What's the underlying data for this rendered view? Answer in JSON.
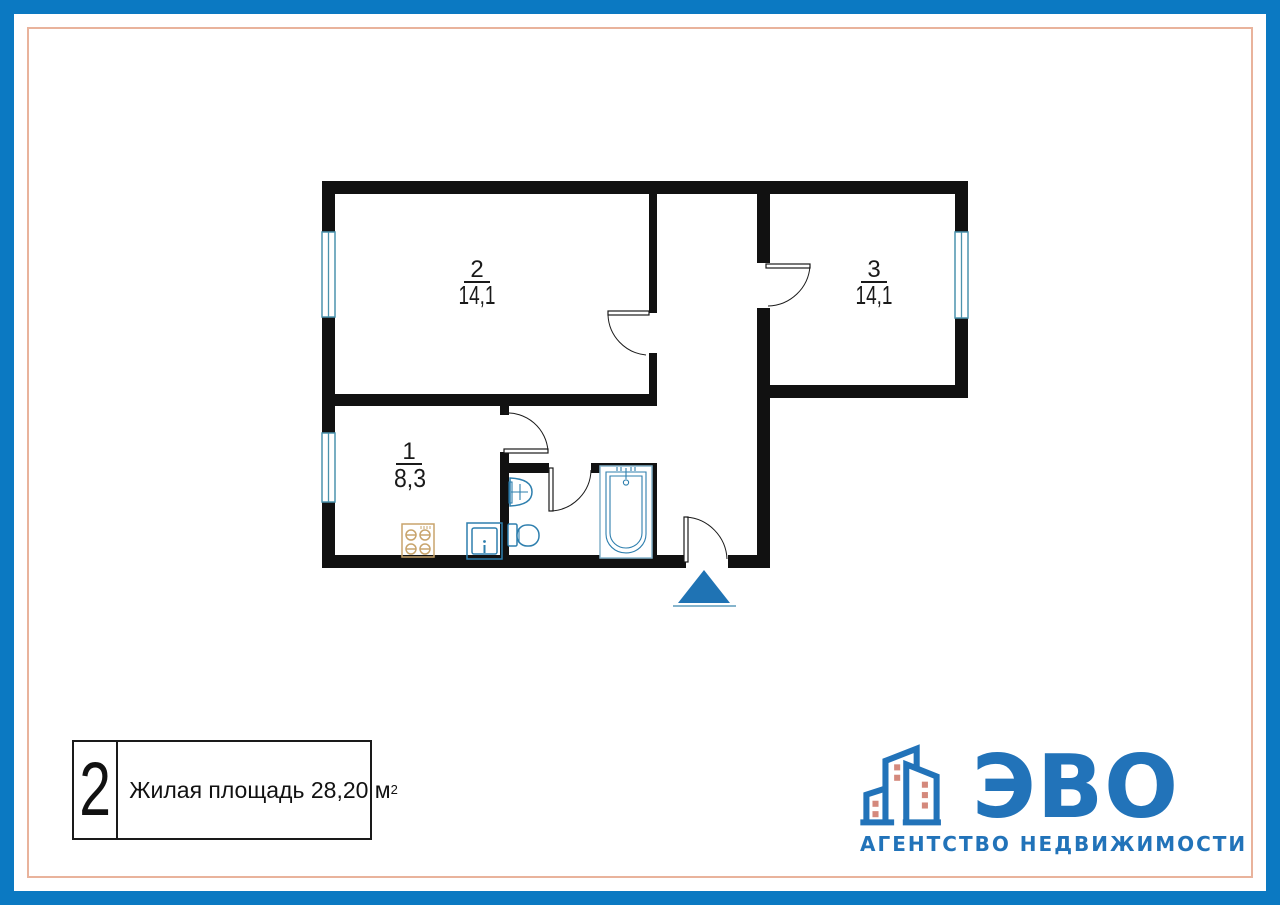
{
  "colors": {
    "frame_blue": "#0b79c2",
    "accent_salmon": "#e9b39c",
    "wall_black": "#111111",
    "window_blue": "#4b93ad",
    "fixture_blue": "#2e7fae",
    "tub_light_blue": "#85b4cc",
    "stove_tan": "#c8a46c",
    "entrance_blue": "#1f73b4",
    "logo_blue": "#2273b9",
    "logo_window_salmon": "#d4897c",
    "text_black": "#1a1a1a"
  },
  "plan": {
    "rooms": [
      {
        "number": "1",
        "area": "8,3"
      },
      {
        "number": "2",
        "area": "14,1"
      },
      {
        "number": "3",
        "area": "14,1"
      }
    ],
    "fixture_icons": [
      "stove-icon",
      "fridge-icon",
      "washbasin-icon",
      "toilet-icon",
      "bathtub-icon",
      "entrance-arrow-icon"
    ]
  },
  "legend": {
    "rooms_count": "2",
    "area_label": "Жилая площадь 28,20 м",
    "area_sup": "2"
  },
  "logo": {
    "name": "ЭВО",
    "subtitle": "АГЕНТСТВО НЕДВИЖИМОСТИ"
  }
}
